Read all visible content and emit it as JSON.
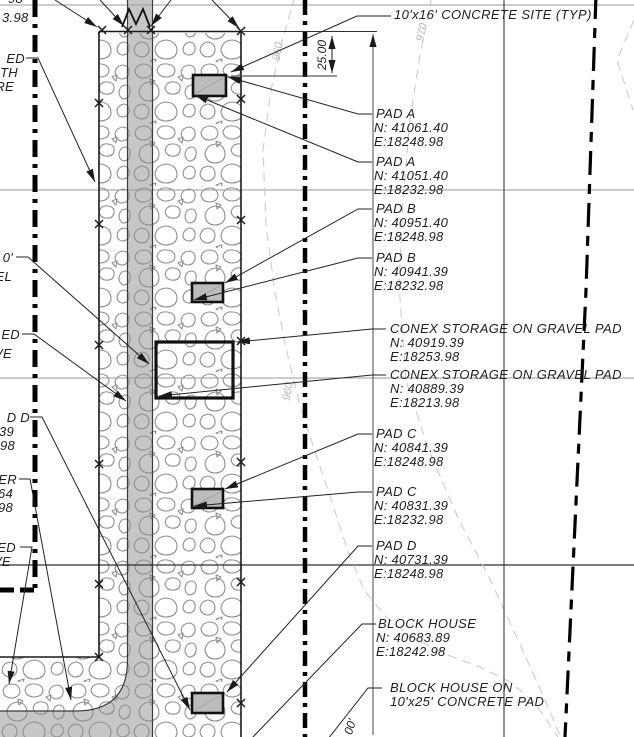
{
  "page": {
    "width": 634,
    "height": 737,
    "background": "#ffffff"
  },
  "colors": {
    "stone_outline": "#8f8f8f",
    "road_fill": "#c6c6c6",
    "pad_fill": "#bcbcbc",
    "grid_line": "#9a9a9a",
    "boundary_line": "#1a1a1a",
    "contour_line": "#cccccc"
  },
  "top_note": {
    "label": "10'x16' CONCRETE SITE (TYP)"
  },
  "dimension": {
    "value": "25.00"
  },
  "station_dim": {
    "value": "00'"
  },
  "contours": [
    {
      "label": "960"
    },
    {
      "label": "970"
    },
    {
      "label": "960"
    }
  ],
  "callouts": [
    {
      "title": "PAD A",
      "n": "N: 41061.40",
      "e": "E:18248.98"
    },
    {
      "title": "PAD A",
      "n": "N: 41051.40",
      "e": "E:18232.98"
    },
    {
      "title": "PAD B",
      "n": "N: 40951.40",
      "e": "E:18248.98"
    },
    {
      "title": "PAD B",
      "n": "N: 40941.39",
      "e": "E:18232.98"
    },
    {
      "title": "CONEX STORAGE ON GRAVEL PAD",
      "n": "N: 40919.39",
      "e": "E:18253.98"
    },
    {
      "title": "CONEX STORAGE ON GRAVEL PAD",
      "n": "N: 40889.39",
      "e": "E:18213.98"
    },
    {
      "title": "PAD C",
      "n": "N: 40841.39",
      "e": "E:18248.98"
    },
    {
      "title": "PAD C",
      "n": "N: 40831.39",
      "e": "E:18232.98"
    },
    {
      "title": "PAD D",
      "n": "N: 40731.39",
      "e": "E:18248.98"
    },
    {
      "title": "BLOCK HOUSE",
      "n": "N: 40683.89",
      "e": "E:18242.98"
    }
  ],
  "pad_note": {
    "line1": "BLOCK HOUSE ON",
    "line2": "10'x25' CONCRETE PAD"
  },
  "left_partial_labels": {
    "coord_top": {
      "line1": "98",
      "line2": "3.98"
    },
    "g1": {
      "line1": "ED",
      "line2": "TH",
      "line3": "RE"
    },
    "g2": {
      "line1": "0'",
      "line2": "EL"
    },
    "g3": {
      "line1": "ED",
      "line2": "VE"
    },
    "g4": {
      "line1": "D D",
      "line2": "39",
      "line3": "98"
    },
    "g5": {
      "line1": "ER",
      "line2": "64",
      "line3": "98"
    },
    "g6": {
      "line1": "ED",
      "line2": "VE"
    }
  }
}
